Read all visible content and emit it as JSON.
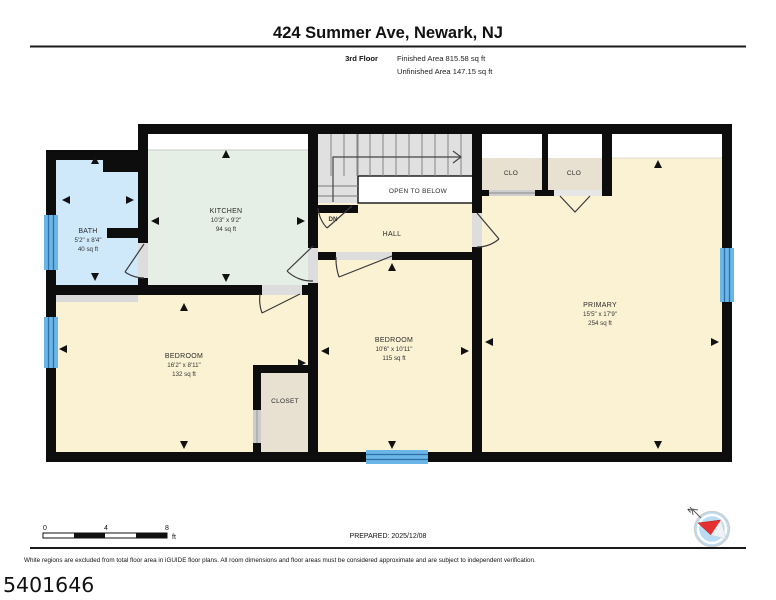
{
  "header": {
    "title": "424 Summer Ave, Newark, NJ",
    "floor_label": "3rd Floor",
    "finished_area": "Finished Area 815.58 sq ft",
    "unfinished_area": "Unfinished Area 147.15 sq ft"
  },
  "rooms": {
    "bath": {
      "name": "BATH",
      "dims": "5'2\" x 8'4\"",
      "area": "40 sq ft"
    },
    "kitchen": {
      "name": "KITCHEN",
      "dims": "10'3\" x 9'2\"",
      "area": "94 sq ft"
    },
    "hall": {
      "name": "HALL"
    },
    "open_to_below": {
      "name": "OPEN TO BELOW"
    },
    "stairs": {
      "direction_label": "DN"
    },
    "clo1": {
      "name": "CLO"
    },
    "clo2": {
      "name": "CLO"
    },
    "primary": {
      "name": "PRIMARY",
      "dims": "15'5\" x 17'9\"",
      "area": "254 sq ft"
    },
    "bedroom_mid": {
      "name": "BEDROOM",
      "dims": "10'6\" x 10'11\"",
      "area": "115 sq ft"
    },
    "bedroom_left": {
      "name": "BEDROOM",
      "dims": "16'2\" x 8'11\"",
      "area": "132 sq ft"
    },
    "closet": {
      "name": "CLOSET"
    }
  },
  "footer": {
    "scale": {
      "ticks": [
        "0",
        "4",
        "8"
      ],
      "unit": "ft"
    },
    "prepared": "PREPARED: 2025/12/08",
    "disclaimer": "White regions are excluded from total floor area in iGUIDE floor plans. All room dimensions and floor areas must be considered approximate and are subject to independent verification.",
    "plan_id": "5401646"
  },
  "compass": {
    "north_label": "N"
  },
  "colors": {
    "wall": "#0d0d0d",
    "room_cream": "#fbf2d4",
    "bath_blue": "#cfe9fb",
    "kitchen_green": "#e5efe6",
    "closet_tan": "#e8e0d1",
    "stairs_gray": "#e0e0e0",
    "window_blue": "#6ab7e7",
    "window_line": "#2d6fa6",
    "compass_red": "#e63030",
    "compass_disc": "#badcf2"
  }
}
